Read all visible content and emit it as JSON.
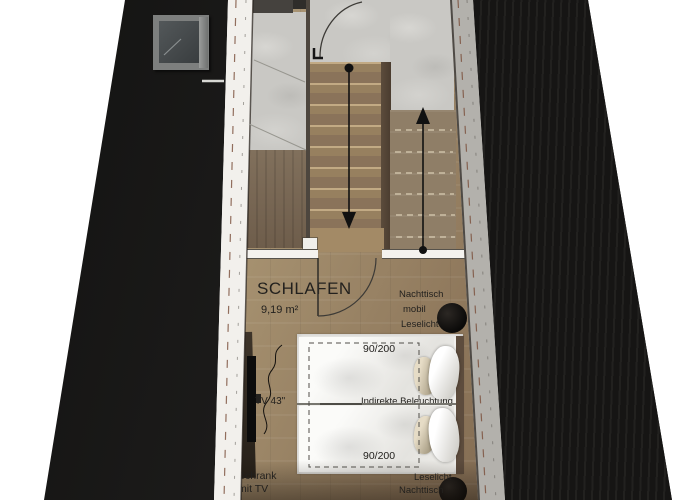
{
  "room": {
    "name": "SCHLAFEN",
    "area": "9,19 m²"
  },
  "annotations": {
    "nightstand_top": {
      "line1": "Nachttisch",
      "line2": "mobil",
      "line3": "Leselicht"
    },
    "bed_size_top": "90/200",
    "bed_size_bottom": "90/200",
    "indirect_lighting": "Indirekte Beleuchtung",
    "tv": "TV 43\"",
    "cabinet_line1": "Schrank",
    "cabinet_line2": "mit TV",
    "reading_light_bottom": "Leselicht",
    "nightstand_bottom": "Nachttisch"
  },
  "icons": {
    "stair_down_arrow": "arrow-down",
    "stair_up_arrow": "arrow-up",
    "door_swing": "quarter-arc",
    "reading_light": "filled-circle",
    "skylight": "roof-window"
  },
  "colors": {
    "background": "#ffffff",
    "roof": "#1a1918",
    "wall_stripe": "#efede9",
    "wall_dash": "#7a4e3a",
    "marble": "#c9c8c4",
    "stair_wood": "#8c765a",
    "floor_wood_light": "#b7a284",
    "floor_wood_dark": "#6f5c48",
    "bed": "#f1f0ed",
    "ink": "#23211e"
  }
}
